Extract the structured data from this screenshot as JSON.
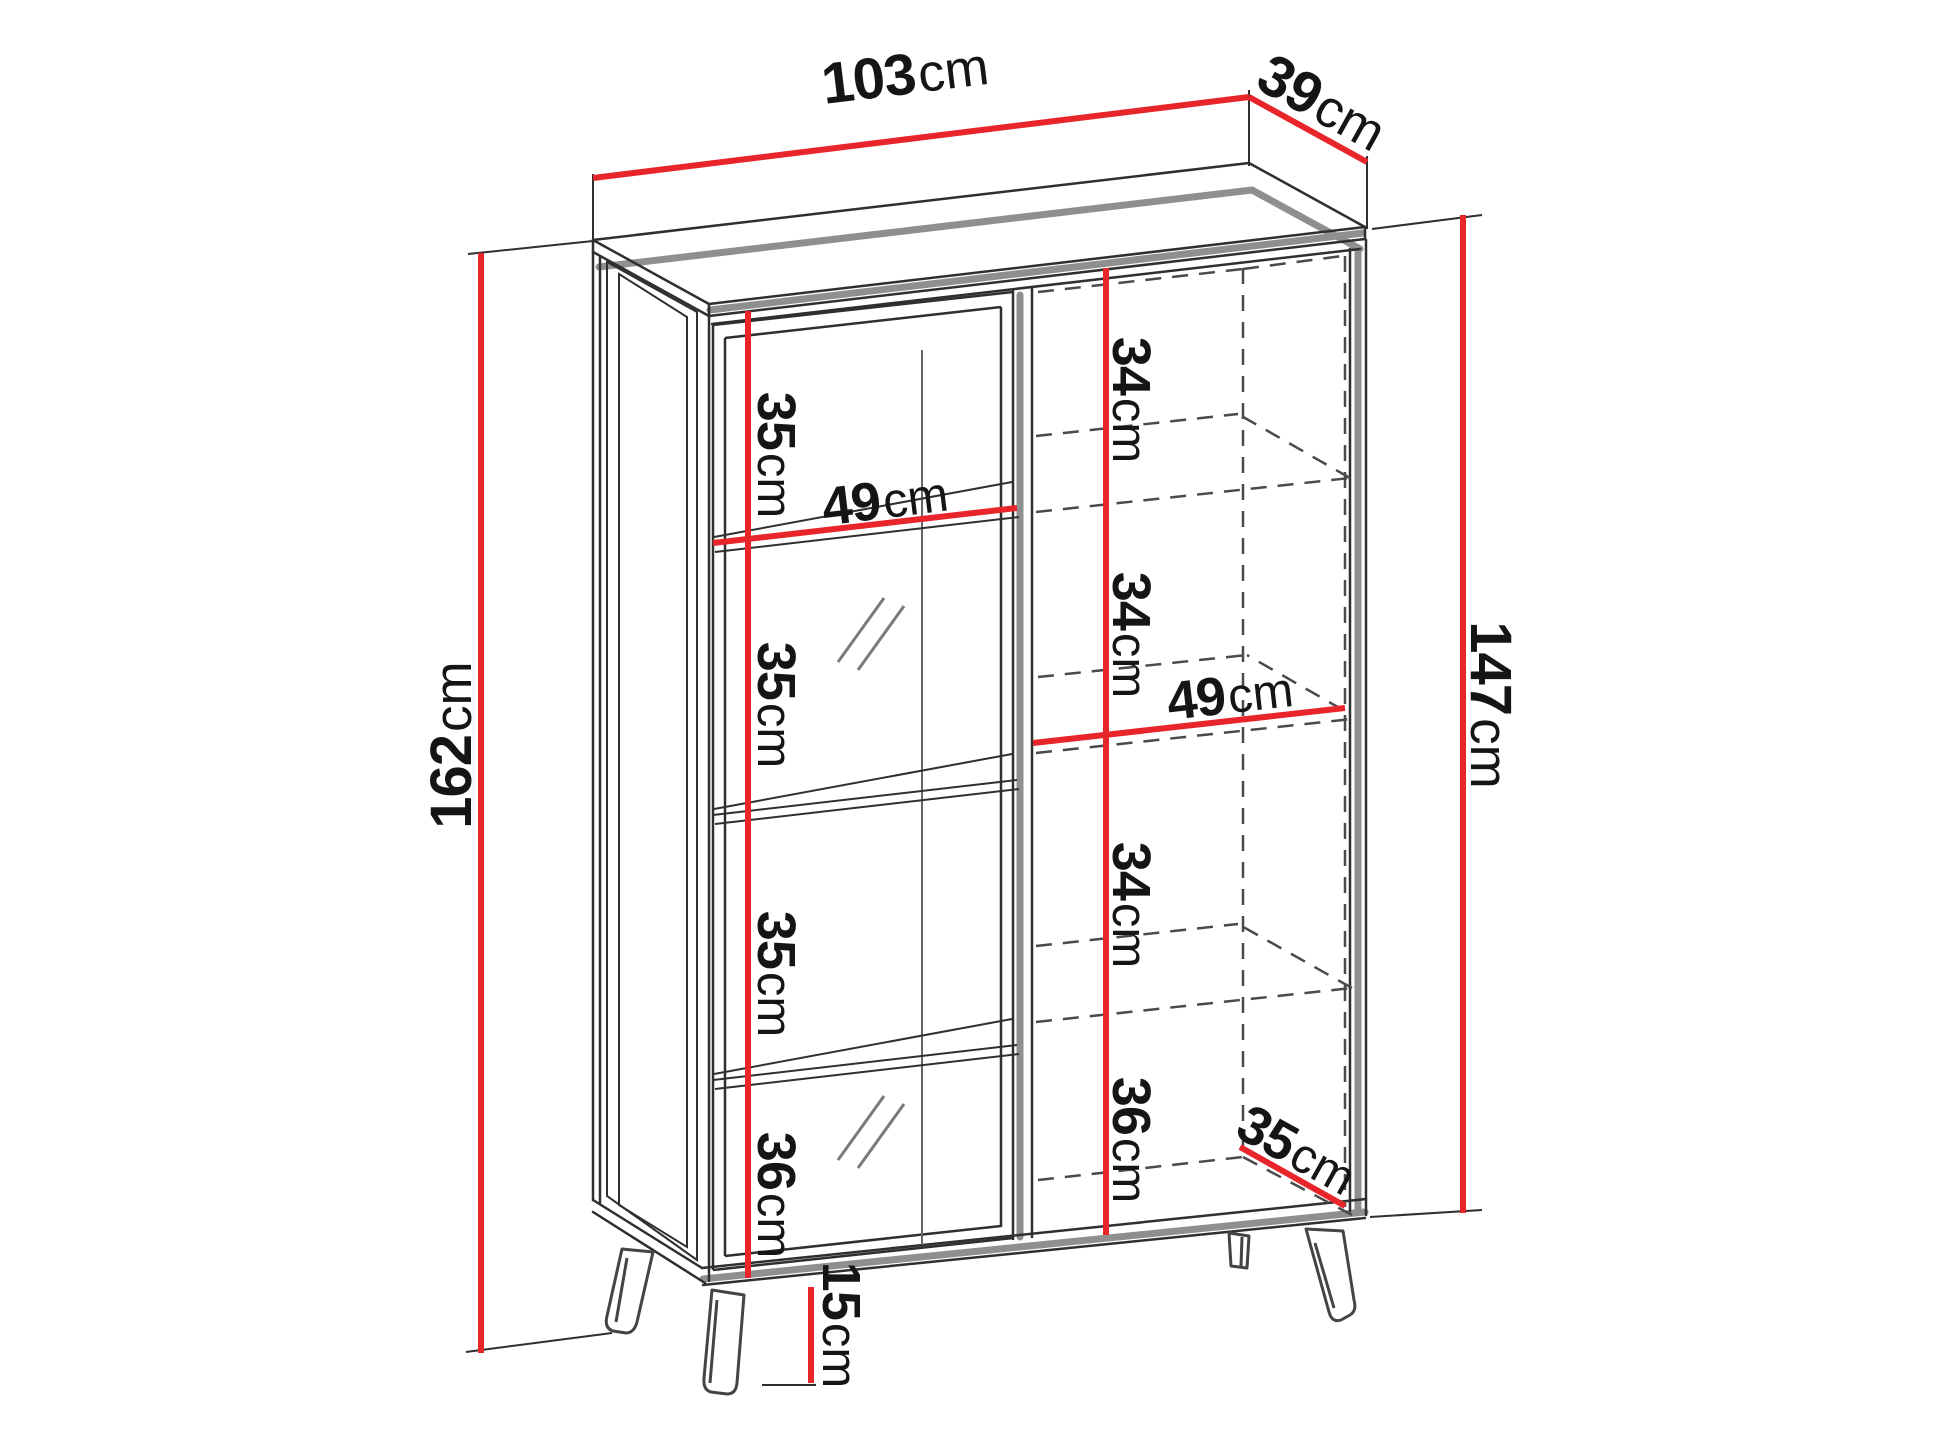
{
  "diagram_title": "cabinet-dimension-diagram",
  "dims": {
    "width_top": {
      "value": "103",
      "unit": "cm"
    },
    "depth_top": {
      "value": "39",
      "unit": "cm"
    },
    "height_total": {
      "value": "162",
      "unit": "cm"
    },
    "height_body": {
      "value": "147",
      "unit": "cm"
    },
    "left_column": [
      {
        "value": "35",
        "unit": "cm"
      },
      {
        "value": "35",
        "unit": "cm"
      },
      {
        "value": "35",
        "unit": "cm"
      },
      {
        "value": "36",
        "unit": "cm"
      }
    ],
    "right_column": [
      {
        "value": "34",
        "unit": "cm"
      },
      {
        "value": "34",
        "unit": "cm"
      },
      {
        "value": "34",
        "unit": "cm"
      },
      {
        "value": "36",
        "unit": "cm"
      }
    ],
    "shelf_width_left": {
      "value": "49",
      "unit": "cm"
    },
    "shelf_width_right": {
      "value": "49",
      "unit": "cm"
    },
    "depth_bottom": {
      "value": "35",
      "unit": "cm"
    },
    "leg_height": {
      "value": "15",
      "unit": "cm"
    }
  },
  "colors": {
    "dimension_red": "#e8252b",
    "outline_black": "#2f2f2f",
    "shadow_gray": "#8f8f8f",
    "background": "#ffffff"
  }
}
